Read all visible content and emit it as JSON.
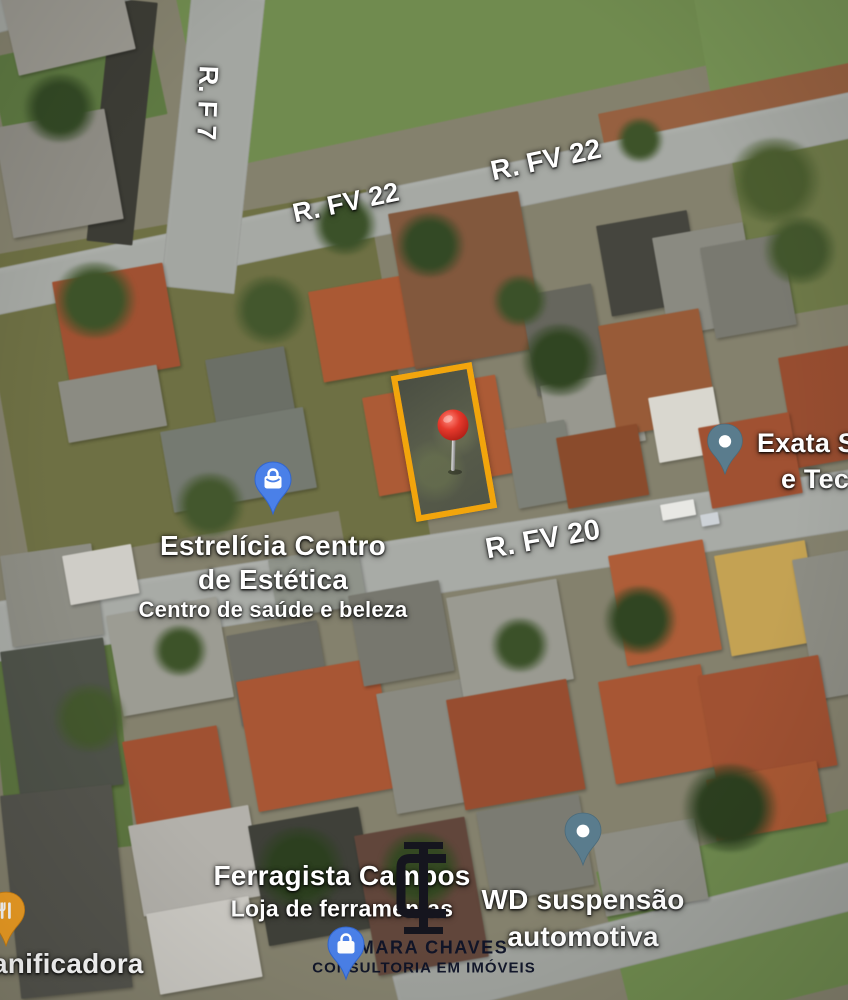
{
  "map": {
    "view": "satellite",
    "streets": {
      "f7": "R. F 7",
      "fv22_a": "R. FV 22",
      "fv22_b": "R. FV 22",
      "fv20": "R. FV 20"
    },
    "pois": {
      "estrelicia": {
        "line1": "Estrelícia Centro",
        "line2": "de Estética",
        "subtitle": "Centro de saúde e beleza",
        "icon": "shopping-bag-pin"
      },
      "exata": {
        "line1": "Exata S",
        "line2": "e Tec",
        "icon": "place-pin"
      },
      "ferragista": {
        "line1": "Ferragista Campos",
        "subtitle": "Loja de ferramentas"
      },
      "wd": {
        "line1": "WD suspensão",
        "line2": "automotiva",
        "icon": "place-pin"
      },
      "panificadora": {
        "line1": "anificadora",
        "icon": "restaurant-pin"
      }
    },
    "property_marker": {
      "icon": "red-pin",
      "outline_color": "#f2a50c"
    },
    "watermark": {
      "line1": "ILMARA CHAVES",
      "line2": "CONSULTORIA EM IMÓVEIS",
      "monogram": "IC",
      "icon": "shopping-bag-pin"
    },
    "icon_colors": {
      "shopping_pin": "#4a80e8",
      "place_pin": "#5a7c8d",
      "restaurant_pin": "#f2a024",
      "red_pin": "#d6281c"
    }
  }
}
